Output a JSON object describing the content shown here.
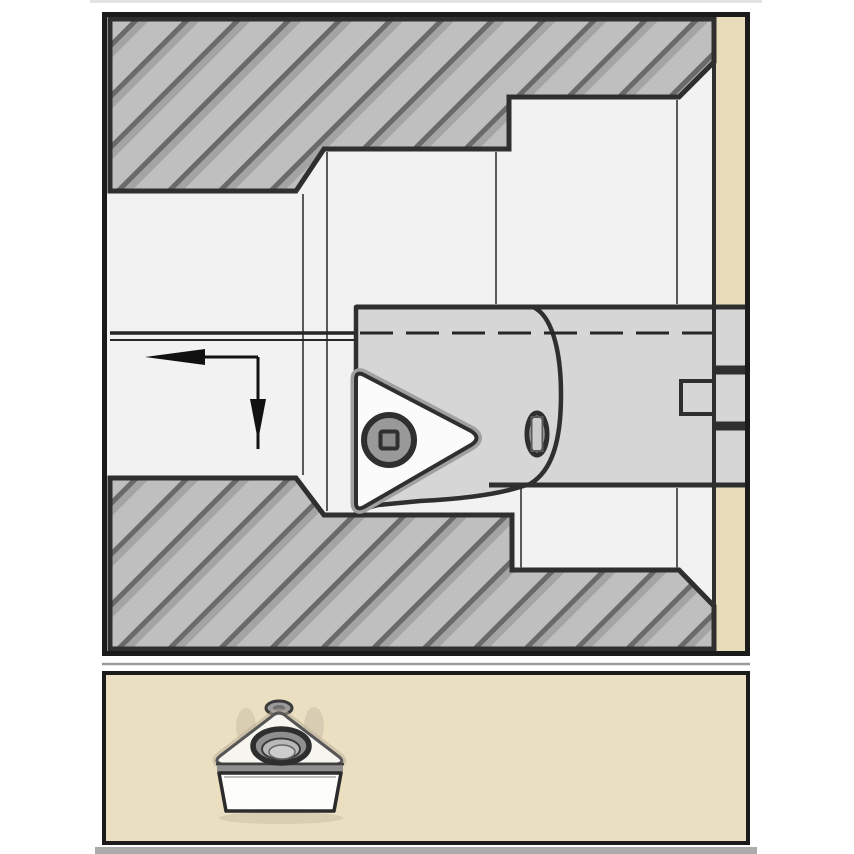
{
  "meta": {
    "description": "Tooling catalog application figure: cross-section of a stepped bore being machined by a boring bar with a screw-clamped triangular insert (top panel) and a 3D pictogram of the indexable insert (bottom panel)",
    "figure_type": "technical-illustration",
    "text_content": "none"
  },
  "colors": {
    "page_bg": "#ffffff",
    "edge_faint": "#e3e3e3",
    "edge_band_gray": "#ababab",
    "panel_border": "#1b1b1b",
    "separator_gray": "#9c9c9c",
    "bore_bg": "#f2f2f2",
    "hatch_base": "#bfbfbf",
    "hatch_stripe_dark": "#6a6a6a",
    "hatch_stripe_mid": "#a4a4a4",
    "outline_dark": "#2f2f2f",
    "tool_gray": "#d6d6d6",
    "insert_white": "#fbfbfb",
    "insert_edge_gray": "#a0a0a0",
    "tan_strip": "#e9dcba",
    "tan_panel": "#ebdfc1",
    "screw_ring": "#999999",
    "screw_socket": "#8a8a8a",
    "shoulder_line": "#5a5a5a",
    "centerline_dark": "#262626",
    "arrow_black": "#111111",
    "insert_face_white": "#f6f5f0",
    "hole_ring_gray": "#8f8f8f",
    "hole_mid_gray": "#b9b9b9",
    "hole_inner_gray": "#cdcdcd",
    "nub_gray": "#9b9b9b",
    "shadow_warm": "#b7ae98"
  },
  "panels": {
    "application_view": {
      "name": "boring-application-cross-section",
      "components": [
        "upper-workpiece-hatch-section",
        "lower-workpiece-hatch-section",
        "stepped-bore-with-entry-chamfers",
        "workpiece-end-face",
        "background-strip",
        "boring-bar-shank",
        "boring-bar-head",
        "triangular-insert",
        "insert-clamp-screw",
        "side-clamp-port",
        "bar-end-notch",
        "feed-direction-arrow-left-then-down",
        "bore-centerline-dashed"
      ]
    },
    "insert_view": {
      "name": "insert-pictogram",
      "components": [
        "trigon-insert-top-face",
        "insert-corner-nub",
        "countersunk-screw-hole",
        "insert-front-face"
      ]
    }
  }
}
